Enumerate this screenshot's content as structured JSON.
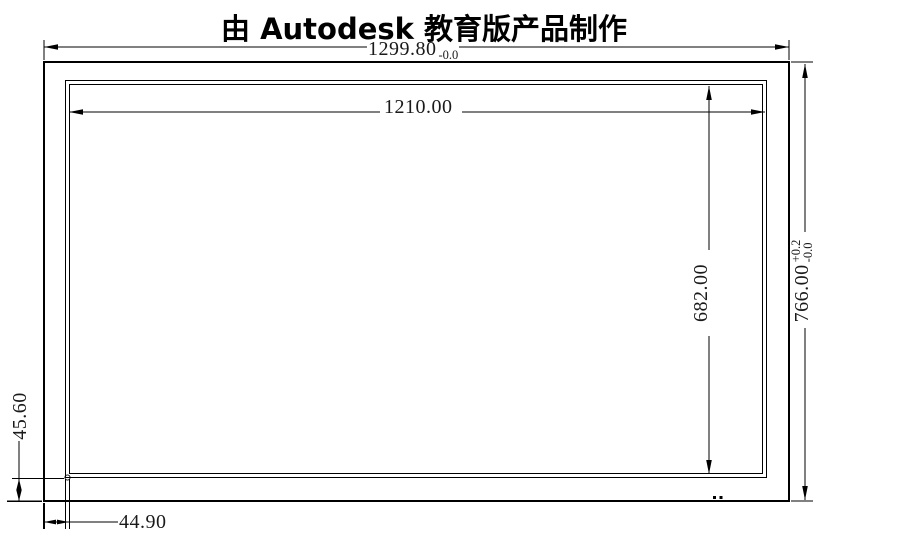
{
  "title": "由 Autodesk 教育版产品制作",
  "dimensions": {
    "outer_width": {
      "value": "1299.80",
      "tol_plus": "",
      "tol_minus": "-0.0"
    },
    "inner_width": {
      "value": "1210.00"
    },
    "outer_height": {
      "value": "766.00",
      "tol_plus": "+0.2",
      "tol_minus": "-0.0"
    },
    "inner_height": {
      "value": "682.00"
    },
    "bottom_border_height": {
      "value": "45.60"
    },
    "left_border_width": {
      "value": "44.90"
    }
  },
  "colors": {
    "line": "#000000",
    "text": "#1a1a1a",
    "background": "#ffffff"
  }
}
